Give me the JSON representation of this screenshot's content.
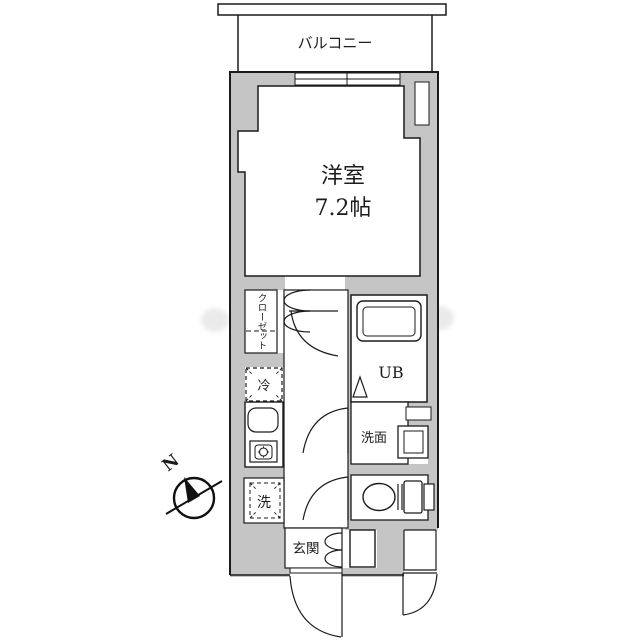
{
  "floor_plan": {
    "balcony": {
      "label": "バルコニー"
    },
    "main_room": {
      "label": "洋室",
      "size": "7.2帖"
    },
    "closet": {
      "label": "クローゼット"
    },
    "unit_bath": {
      "label": "UB"
    },
    "washroom": {
      "label": "洗面"
    },
    "refrigerator": {
      "label": "冷"
    },
    "washer": {
      "label": "洗"
    },
    "entrance": {
      "label": "玄関"
    },
    "compass": {
      "label": "N"
    },
    "colors": {
      "wall_fill": "#c5c5c5",
      "line": "#1b1b1b",
      "background": "#ffffff",
      "text": "#1c1c1c"
    }
  }
}
